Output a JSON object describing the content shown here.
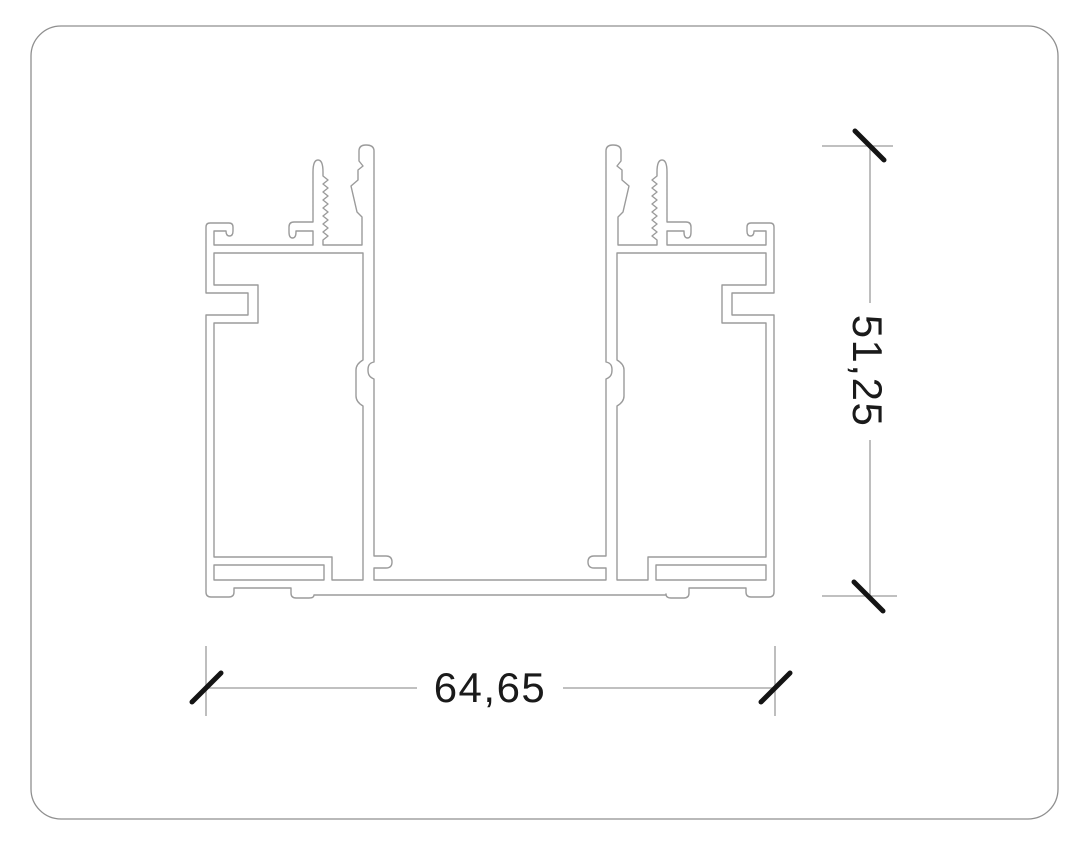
{
  "drawing": {
    "title": "aluminium-profile-cross-section",
    "dimensions": {
      "width_label": "64,65",
      "height_label": "51,25"
    },
    "colors": {
      "background": "#ffffff",
      "border": "#8f8f8f",
      "profile_line": "#9b9b9b",
      "dimension_line": "#9b9b9b",
      "tick": "#141414",
      "text": "#1a1a1a"
    }
  }
}
